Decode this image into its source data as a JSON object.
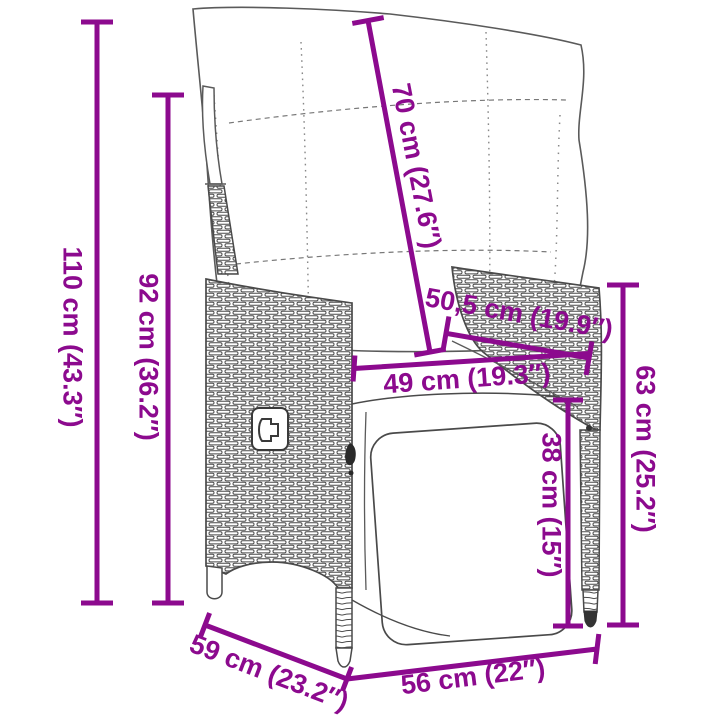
{
  "diagram": {
    "accent_color": "#8C0A8E",
    "art_color": "#4A4A4A",
    "background_color": "#FFFFFF",
    "dimensions": [
      {
        "id": "total-height",
        "label": "110 cm (43.3″)"
      },
      {
        "id": "backrest-height",
        "label": "92 cm (36.2″)"
      },
      {
        "id": "back-cushion-length",
        "label": "70 cm (27.6″)"
      },
      {
        "id": "armrest-length",
        "label": "50,5 cm (19.9″)"
      },
      {
        "id": "seat-width",
        "label": "49 cm (19.3″)"
      },
      {
        "id": "armrest-height",
        "label": "63 cm (25.2″)"
      },
      {
        "id": "seat-height",
        "label": "38 cm (15″)"
      },
      {
        "id": "seat-depth",
        "label": "59 cm (23.2″)"
      },
      {
        "id": "front-width",
        "label": "56 cm (22″)"
      }
    ]
  }
}
